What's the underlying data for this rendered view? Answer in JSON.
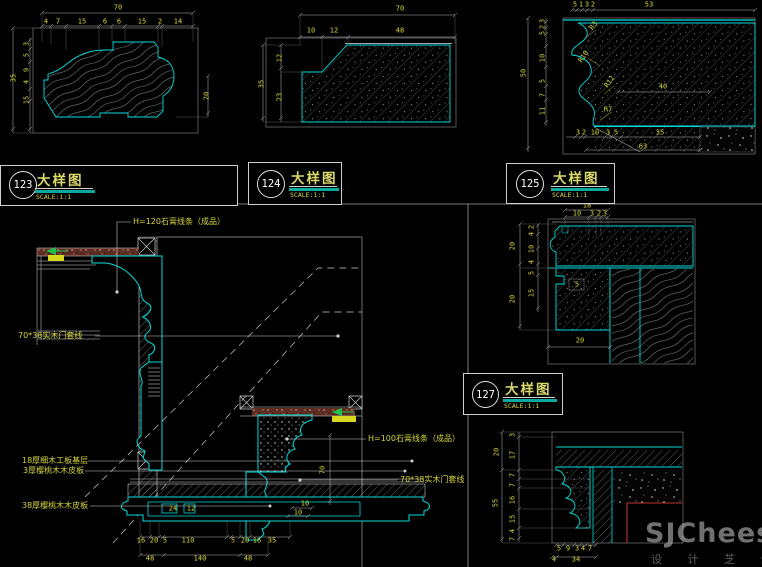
{
  "palette": {
    "cyan": "#00dcdc",
    "dim_text": "#d6d63e",
    "line": "#cfcfcf",
    "red": "#c03030",
    "green": "#1fbf4f",
    "highlight": "#d8d820",
    "slab": "#5d2d22"
  },
  "labels": {
    "b123": {
      "num": "123",
      "title": "大样图",
      "scale": "SCALE:1:1"
    },
    "b124": {
      "num": "124",
      "title": "大样图",
      "scale": "SCALE:1:1"
    },
    "b125": {
      "num": "125",
      "title": "大样图",
      "scale": "SCALE:1:1"
    },
    "b127": {
      "num": "127",
      "title": "大样图",
      "scale": "SCALE:1:1"
    }
  },
  "d123": {
    "top_total": "70",
    "top": [
      "4",
      "7",
      "15",
      "6",
      "6",
      "15",
      "2",
      "14"
    ],
    "left_total": "35",
    "left": [
      "3",
      "5",
      "9",
      "4",
      "15"
    ],
    "right": "20"
  },
  "d124": {
    "top_total": "70",
    "top": [
      "10",
      "12",
      "48"
    ],
    "left_total": "35",
    "left": [
      "12",
      "23"
    ]
  },
  "d125": {
    "top_total": "53",
    "top": [
      "5",
      "1",
      "3",
      "2"
    ],
    "left_total": "50",
    "left": [
      "3",
      "2",
      "5",
      "10",
      "5",
      "7",
      "11"
    ],
    "radii": [
      "R3",
      "R10",
      "R12",
      "R7"
    ],
    "inner_width": "40",
    "bottom": [
      "3",
      "2",
      "10",
      "3",
      "5",
      "35"
    ],
    "bottom_total": "63"
  },
  "d127": {
    "top_total": "18",
    "top": [
      "10",
      "3",
      "2",
      "3"
    ],
    "left_outer": [
      "20",
      "20"
    ],
    "left_inner": [
      "2",
      "4",
      "10",
      "4",
      "5",
      "15"
    ],
    "notch": "5",
    "bottom_width": "20"
  },
  "d128": {
    "left_outer": [
      "20",
      "55"
    ],
    "left_inner": [
      "3",
      "17",
      "7",
      "7",
      "16",
      "15",
      "4",
      "7"
    ],
    "bottom_row1": [
      "5",
      "9",
      "3",
      "4",
      "7"
    ],
    "bottom_row2": [
      "4",
      "34"
    ]
  },
  "stair": {
    "callouts": {
      "h120": "H=120石膏线条（成品）",
      "door_top": "70*38实木门套线",
      "h100": "H=100石膏线条（成品）",
      "door_mid": "70*38实木门套线",
      "base_18": "18厚细木工板基层",
      "veneer_3": "3厚樱桃木木皮板",
      "veneer_38": "38厚樱桃木木皮板"
    },
    "dims": {
      "v70": "70",
      "s10a": "10",
      "s10b": "10",
      "panel": [
        "24",
        "12"
      ],
      "row1": [
        "16",
        "20",
        "5",
        "110",
        "5",
        "20",
        "16",
        "35"
      ],
      "row2": [
        "48",
        "140",
        "48"
      ]
    }
  },
  "watermark": {
    "brand": "SJCheese",
    "sub": "设 计 芝 士"
  }
}
